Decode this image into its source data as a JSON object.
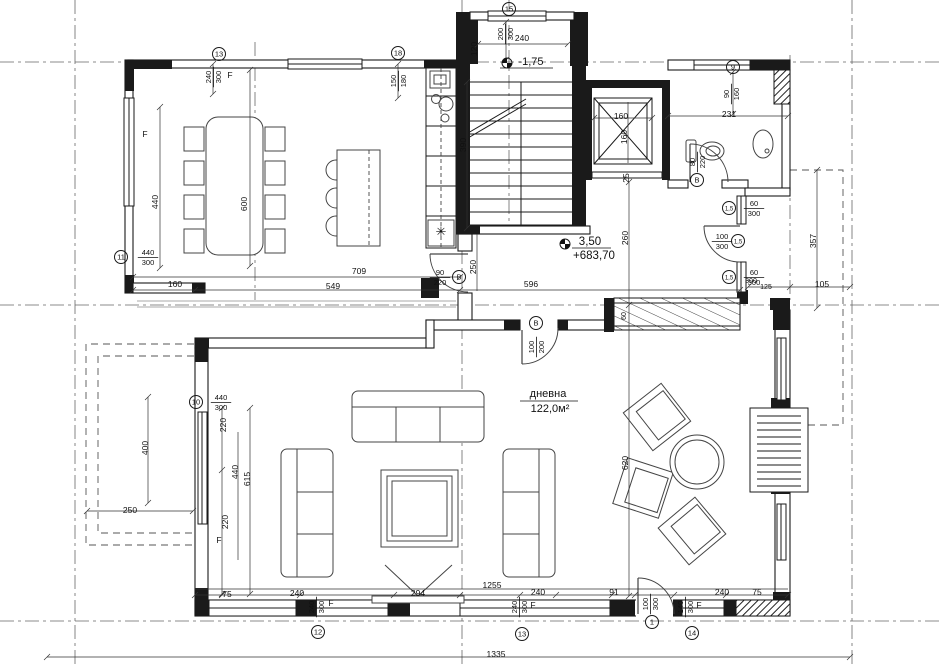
{
  "colors": {
    "ink": "#1a1a1a",
    "paper": "#ffffff"
  },
  "room": {
    "name": "дневна",
    "area": "122,0м²"
  },
  "levels": [
    {
      "value": "-1,75"
    },
    {
      "value": "3,50",
      "elevation": "+683,70"
    }
  ],
  "annotations": [
    {
      "t": "240",
      "x": 522,
      "y": 41
    },
    {
      "t": "120",
      "x": 477,
      "y": 49,
      "r": -90
    },
    {
      "t": "390",
      "x": 466,
      "y": 145,
      "r": -90
    },
    {
      "t": "F",
      "x": 230,
      "y": 78
    },
    {
      "t": "F",
      "x": 145,
      "y": 137
    },
    {
      "t": "440",
      "x": 158,
      "y": 202,
      "r": -90
    },
    {
      "t": "600",
      "x": 247,
      "y": 204,
      "r": -90
    },
    {
      "t": "160",
      "x": 175,
      "y": 287
    },
    {
      "t": "709",
      "x": 359,
      "y": 274
    },
    {
      "t": "549",
      "x": 333,
      "y": 289
    },
    {
      "t": "250",
      "x": 476,
      "y": 267,
      "r": -90
    },
    {
      "t": "596",
      "x": 531,
      "y": 287
    },
    {
      "t": "260",
      "x": 628,
      "y": 238,
      "r": -90
    },
    {
      "t": "25",
      "x": 629,
      "y": 178,
      "r": -90
    },
    {
      "t": "160",
      "x": 621,
      "y": 119
    },
    {
      "t": "160",
      "x": 627,
      "y": 137,
      "r": -90
    },
    {
      "t": "231",
      "x": 729,
      "y": 117
    },
    {
      "t": "300",
      "x": 751,
      "y": 283,
      "s": 7
    },
    {
      "t": "125",
      "x": 766,
      "y": 289,
      "s": 7
    },
    {
      "t": "105",
      "x": 822,
      "y": 287
    },
    {
      "t": "357",
      "x": 816,
      "y": 241,
      "r": -90
    },
    {
      "t": "60",
      "x": 626,
      "y": 316,
      "r": -90,
      "s": 7
    },
    {
      "t": "620",
      "x": 628,
      "y": 463,
      "r": -90
    },
    {
      "t": "220",
      "x": 226,
      "y": 425,
      "r": -90
    },
    {
      "t": "440",
      "x": 238,
      "y": 472,
      "r": -90
    },
    {
      "t": "615",
      "x": 250,
      "y": 479,
      "r": -90
    },
    {
      "t": "220",
      "x": 228,
      "y": 522,
      "r": -90
    },
    {
      "t": "F",
      "x": 219,
      "y": 543
    },
    {
      "t": "400",
      "x": 148,
      "y": 448,
      "r": -90
    },
    {
      "t": "250",
      "x": 130,
      "y": 513
    },
    {
      "t": "75",
      "x": 227,
      "y": 597
    },
    {
      "t": "240",
      "x": 297,
      "y": 596
    },
    {
      "t": "294",
      "x": 418,
      "y": 596
    },
    {
      "t": "1255",
      "x": 492,
      "y": 588
    },
    {
      "t": "240",
      "x": 538,
      "y": 595
    },
    {
      "t": "91",
      "x": 614,
      "y": 595
    },
    {
      "t": "240",
      "x": 722,
      "y": 595
    },
    {
      "t": "75",
      "x": 757,
      "y": 595
    },
    {
      "t": "1335",
      "x": 496,
      "y": 657
    },
    {
      "t": "F",
      "x": 331,
      "y": 606
    },
    {
      "t": "F",
      "x": 533,
      "y": 608
    },
    {
      "t": "F",
      "x": 699,
      "y": 608
    },
    {
      "t": "✳",
      "x": 441,
      "y": 236,
      "s": 13
    }
  ],
  "fractions": [
    {
      "a": "200",
      "b": "300",
      "x": 505,
      "y": 34,
      "r": -90
    },
    {
      "a": "240",
      "b": "300",
      "x": 213,
      "y": 77,
      "r": -90
    },
    {
      "a": "150",
      "b": "180",
      "x": 398,
      "y": 81,
      "r": -90
    },
    {
      "a": "440",
      "b": "300",
      "x": 148,
      "y": 257
    },
    {
      "a": "90",
      "b": "220",
      "x": 440,
      "y": 277
    },
    {
      "a": "100",
      "b": "200",
      "x": 536,
      "y": 347,
      "r": -90
    },
    {
      "a": "80",
      "b": "220",
      "x": 697,
      "y": 162,
      "r": -90
    },
    {
      "a": "90",
      "b": "160",
      "x": 731,
      "y": 94,
      "r": -90
    },
    {
      "a": "60",
      "b": "300",
      "x": 754,
      "y": 208
    },
    {
      "a": "100",
      "b": "300",
      "x": 722,
      "y": 241
    },
    {
      "a": "60",
      "b": "300",
      "x": 754,
      "y": 277
    },
    {
      "a": "440",
      "b": "300",
      "x": 221,
      "y": 402
    },
    {
      "a": "240",
      "b": "300",
      "x": 316,
      "y": 607,
      "r": -90
    },
    {
      "a": "240",
      "b": "300",
      "x": 519,
      "y": 607,
      "r": -90
    },
    {
      "a": "100",
      "b": "300",
      "x": 650,
      "y": 604,
      "r": -90
    },
    {
      "a": "140",
      "b": "300",
      "x": 685,
      "y": 607,
      "r": -90
    }
  ],
  "markers": [
    {
      "t": "13",
      "x": 219,
      "y": 54
    },
    {
      "t": "18",
      "x": 398,
      "y": 53
    },
    {
      "t": "15",
      "x": 509,
      "y": 9
    },
    {
      "t": "9",
      "x": 733,
      "y": 67
    },
    {
      "t": "11",
      "x": 121,
      "y": 257
    },
    {
      "t": "B",
      "x": 459,
      "y": 277
    },
    {
      "t": "B",
      "x": 536,
      "y": 323
    },
    {
      "t": "B",
      "x": 697,
      "y": 180
    },
    {
      "t": "1,5",
      "x": 729,
      "y": 208
    },
    {
      "t": "1,5",
      "x": 738,
      "y": 241
    },
    {
      "t": "1,5",
      "x": 729,
      "y": 277
    },
    {
      "t": "10",
      "x": 196,
      "y": 402
    },
    {
      "t": "12",
      "x": 318,
      "y": 632
    },
    {
      "t": "13",
      "x": 522,
      "y": 634
    },
    {
      "t": "1",
      "x": 652,
      "y": 622
    },
    {
      "t": "14",
      "x": 692,
      "y": 633
    }
  ]
}
